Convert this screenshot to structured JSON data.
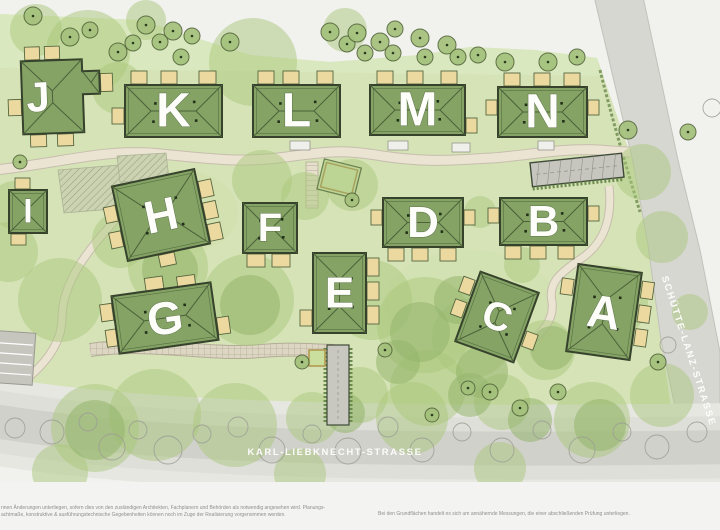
{
  "map": {
    "streets": {
      "bottom": "KARL-LIEBKNECHT-STRASSE",
      "right": "SCHÜTTE-LANZ-STRASSE"
    },
    "buildings": [
      {
        "id": "A",
        "label": "A"
      },
      {
        "id": "B",
        "label": "B"
      },
      {
        "id": "C",
        "label": "C"
      },
      {
        "id": "D",
        "label": "D"
      },
      {
        "id": "E",
        "label": "E"
      },
      {
        "id": "F",
        "label": "F"
      },
      {
        "id": "G",
        "label": "G"
      },
      {
        "id": "H",
        "label": "H"
      },
      {
        "id": "I",
        "label": "I"
      },
      {
        "id": "J",
        "label": "J"
      },
      {
        "id": "K",
        "label": "K"
      },
      {
        "id": "L",
        "label": "L"
      },
      {
        "id": "M",
        "label": "M"
      },
      {
        "id": "N",
        "label": "N"
      }
    ],
    "footer": {
      "left_line1": "nnen Änderungen unterliegen, sofern dies von den zuständigen Architekten, Fachplanern und Behörden als notwendig angesehen wird. Planungs-",
      "left_line2": "achtmaße, konstruktive & ausführungstechnische Gegebenheiten können noch im Zuge der Realisierung vorgenommen werden.",
      "right": "Bei den Grundflächen handelt es sich um annähernde Messungen, die einer abschließenden Prüfung unterliegen."
    },
    "colors": {
      "site": "#d6e3b7",
      "site_top": "#dbe9c1",
      "roof": "#84a365",
      "roof_line": "#4c6139",
      "outline": "#36422c",
      "terrace": "#ecd9a0",
      "street": "#d7d7d2",
      "road": "#d1d1cb",
      "sidewalk": "#dfdfda",
      "path": "#ece4d3",
      "tree": "#a9c77c",
      "tree_dark": "#93b56c",
      "letter": "#fdfdfa"
    }
  }
}
